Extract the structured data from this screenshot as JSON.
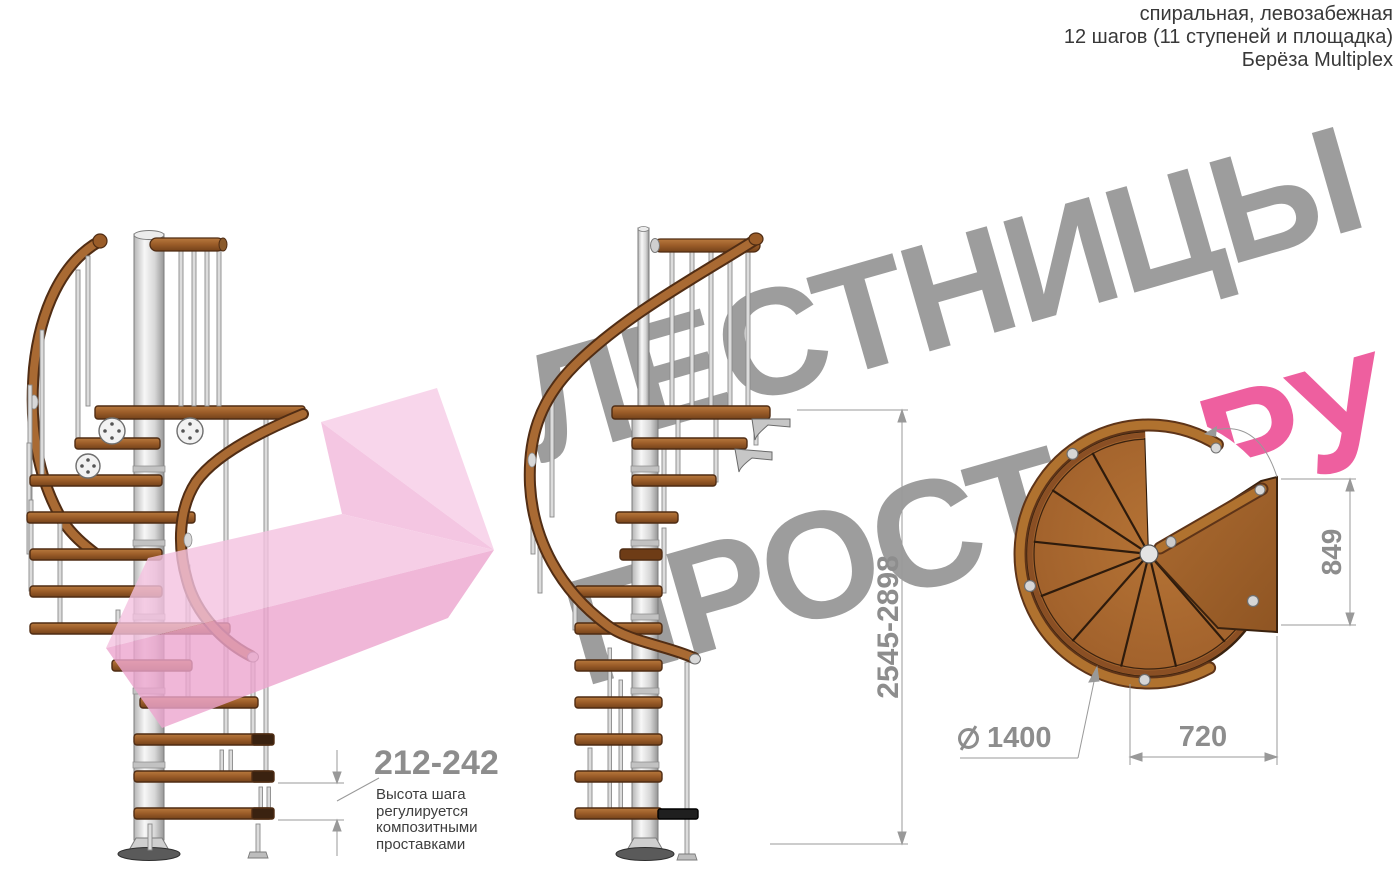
{
  "header": {
    "line1": "спиральная, левозабежная",
    "line2": "12 шагов (11 ступеней и площадка)",
    "line3": "Берёза Multiplex"
  },
  "watermark": {
    "word1": "ЛЕСТНИЦЫ",
    "word2": "ПРОСТО",
    "accent": ".РУ"
  },
  "dimensions": {
    "step_height_range": "212-242",
    "step_height_note": [
      "Высота шага",
      "регулируется",
      "композитными",
      "проставками"
    ],
    "total_height_range": "2545-2898",
    "landing_depth": "849",
    "diameter_value": "1400",
    "landing_width": "720"
  },
  "colors": {
    "watermark_gray": "#9d9d9d",
    "accent_pink": "#ee5f9f",
    "dimension_gray": "#8d8d8d",
    "wood_brown": "#9a5c28",
    "arrow_pink": "#f2b8db",
    "pole_silver": "#d9d9d9"
  }
}
